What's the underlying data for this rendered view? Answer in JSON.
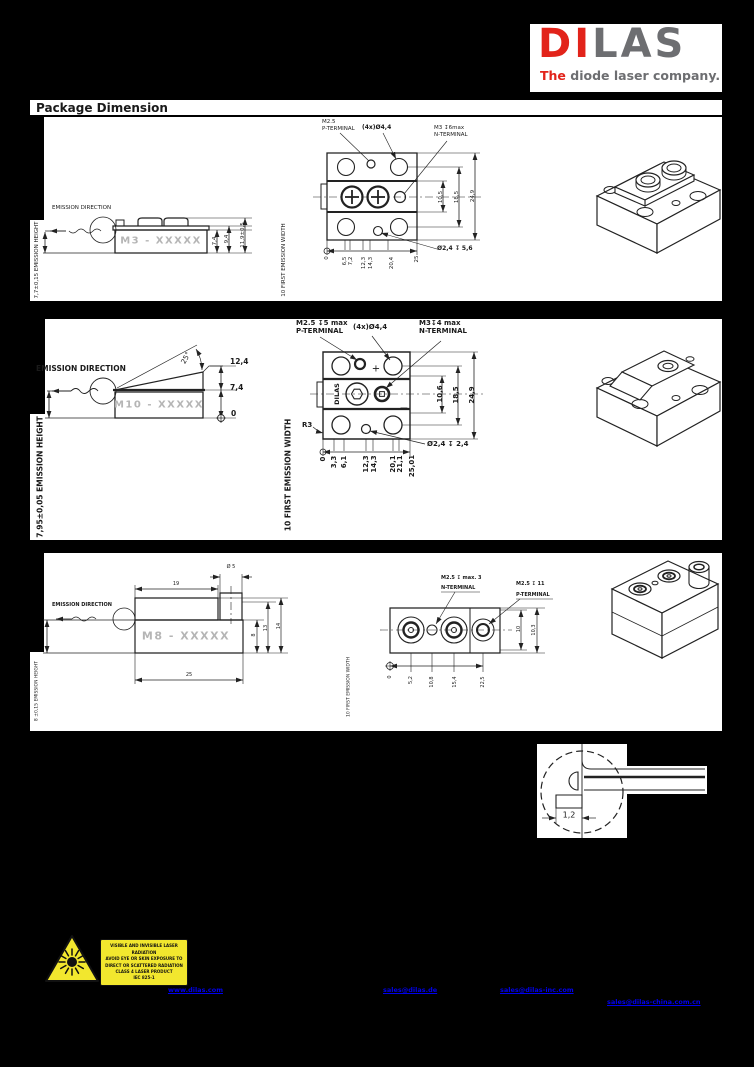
{
  "logo": {
    "part1": "DI",
    "part2": "LAS",
    "tagline_lead": "The",
    "tagline_rest": " diode laser company.",
    "accent_color": "#e2231a",
    "gray_color": "#6d6e71"
  },
  "header": {
    "title": "Package Dimension"
  },
  "m3": {
    "model": "M3 - XXXXX",
    "emission_direction": "EMISSION DIRECTION",
    "emission_height": "7,7±0,15 EMISSION HEIGHT",
    "emission_width": "10 FIRST EMISSION WIDTH",
    "side_dims": [
      "7,4",
      "9,4",
      "11,9±0,5"
    ],
    "label_p1": "M2.5",
    "label_p2": "P-TERMINAL",
    "label_holes": "(4x)Ø4,4",
    "label_n1": "M3 ↧6max",
    "label_n2": "N-TERMINAL",
    "label_bore": "Ø2,4 ↧ 5,6",
    "right_dims": [
      "10,5",
      "18,5",
      "24,9"
    ],
    "bottom_dims": [
      "0",
      "6,5",
      "7,2",
      "12,3",
      "14,3",
      "20,4",
      "25"
    ]
  },
  "m10": {
    "model": "M10 - XXXXX",
    "emission_direction": "EMISSION DIRECTION",
    "emission_height": "7,95±0,05 EMISSION HEIGHT",
    "emission_width": "10 FIRST EMISSION WIDTH",
    "angle": "25°",
    "side_dims": [
      "12,4",
      "7,4",
      "0"
    ],
    "label_p1": "M2.5 ↧5 max",
    "label_p2": "P-TERMINAL",
    "label_holes": "(4x)Ø4,4",
    "label_n1": "M3↧4 max",
    "label_n2": "N-TERMINAL",
    "label_bore": "Ø2,4 ↧ 2,4",
    "label_radius": "R3",
    "brand_mark": "DILAS",
    "plus": "+",
    "minus": "−",
    "right_dims": [
      "10,6",
      "18,5",
      "24,9"
    ],
    "bottom_dims": [
      "0",
      "3,3",
      "6,1",
      "12,3",
      "14,3",
      "20,1",
      "21,1",
      "25,01"
    ]
  },
  "m8": {
    "model": "M8 - XXXXX",
    "emission_direction": "EMISSION DIRECTION",
    "emission_height": "8 ±0,15 EMISSION HEIGHT",
    "emission_width": "10 FIRST EMISSION WIDTH",
    "top_dims": [
      "Ø 5",
      "19"
    ],
    "bottom_length": "25",
    "side_right_dims": [
      "8",
      "13",
      "14"
    ],
    "label_n1": "M2.5 ↧ max. 3",
    "label_n2": "N-TERMINAL",
    "label_p1": "M2.5 ↧ 11",
    "label_p2": "P-TERMINAL",
    "right_dims": [
      "10",
      "10,3"
    ],
    "bottom_dims": [
      "0",
      "5,2",
      "10,8",
      "15,4",
      "22,5"
    ]
  },
  "detail": {
    "dim": "1,2"
  },
  "warning": {
    "lines": [
      "VISIBLE AND INVISIBLE LASER RADIATION",
      "AVOID EYE OR SKIN EXPOSURE TO",
      "DIRECT OR SCATTERED RADIATION",
      "CLASS 4 LASER PRODUCT",
      "IEC 825-1"
    ]
  },
  "footer": {
    "links": [
      {
        "label": "www.dilas.com"
      },
      {
        "label": "sales@dilas.de"
      },
      {
        "label": "sales@dilas-inc.com"
      },
      {
        "label": "sales@dilas-china.com.cn"
      }
    ]
  }
}
